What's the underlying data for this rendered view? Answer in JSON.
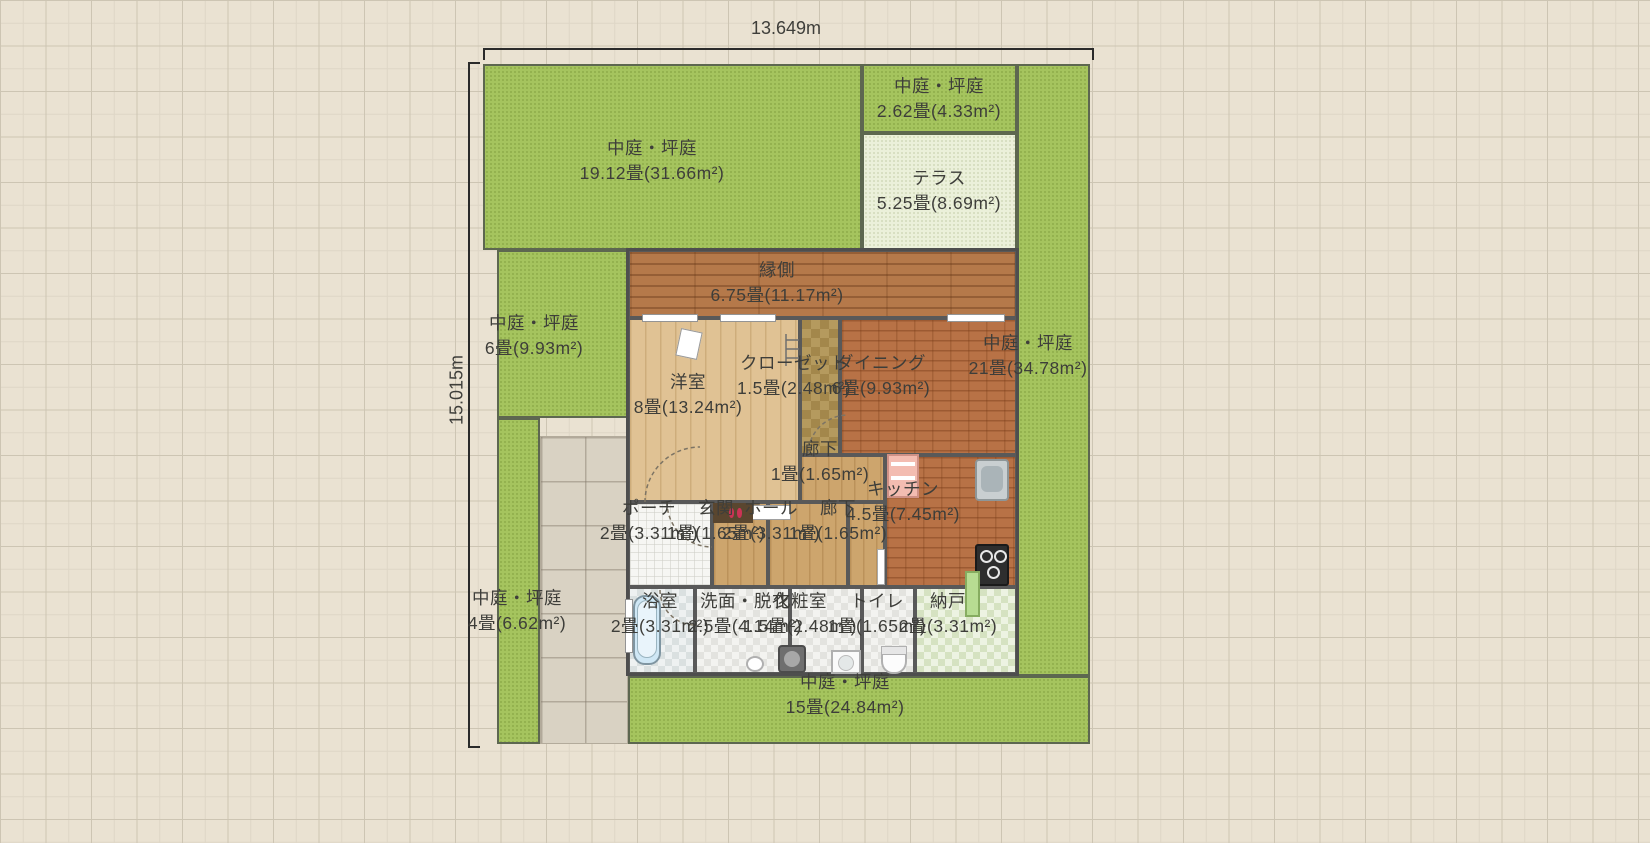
{
  "dimensions": {
    "width_label": "13.649m",
    "height_label": "15.015m"
  },
  "gardens": {
    "g19": {
      "name": "中庭・坪庭",
      "area": "19.12畳(31.66m²)"
    },
    "g262": {
      "name": "中庭・坪庭",
      "area": "2.62畳(4.33m²)"
    },
    "terrace": {
      "name": "テラス",
      "area": "5.25畳(8.69m²)"
    },
    "g21": {
      "name": "中庭・坪庭",
      "area": "21畳(34.78m²)"
    },
    "g6": {
      "name": "中庭・坪庭",
      "area": "6畳(9.93m²)"
    },
    "g4": {
      "name": "中庭・坪庭",
      "area": "4畳(6.62m²)"
    },
    "g15": {
      "name": "中庭・坪庭",
      "area": "15畳(24.84m²)"
    }
  },
  "rooms": {
    "engawa": {
      "name": "縁側",
      "area": "6.75畳(11.17m²)"
    },
    "youshitsu": {
      "name": "洋室",
      "area": "8畳(13.24m²)"
    },
    "closet": {
      "name": "クローゼット",
      "area": "1.5畳(2.48m²)"
    },
    "dining": {
      "name": "ダイニング",
      "area": "6畳(9.93m²)"
    },
    "rouka1": {
      "name": "廊下",
      "area": "1畳(1.65m²)"
    },
    "kitchen": {
      "name": "キッチン",
      "area": "4.5畳(7.45m²)"
    },
    "porch": {
      "name": "ポーチ",
      "area": "2畳(3.31m²)"
    },
    "genkan": {
      "name": "玄関",
      "area": "1畳(1.65m²)"
    },
    "hall": {
      "name": "ホール",
      "area": "2畳(3.31m²)"
    },
    "rouka2": {
      "name": "廊下",
      "area": "1畳(1.65m²)"
    },
    "bath": {
      "name": "浴室",
      "area": "2畳(3.31m²)"
    },
    "senmen": {
      "name": "洗面・脱衣",
      "area": "2.5畳(4.14m²)"
    },
    "keshou": {
      "name": "化粧室",
      "area": "1.5畳(2.48m²)"
    },
    "toilet": {
      "name": "トイレ",
      "area": "1畳(1.65m²)"
    },
    "nando": {
      "name": "納戸",
      "area": "2畳(3.31m²)"
    }
  },
  "colors": {
    "garden_green": "#a5c45e",
    "terrace_green": "#ebf0da",
    "engawa_wood": "#b5794a",
    "brick_floor": "#b87246",
    "wall": "#4e4e4e",
    "background": "#eae2d2"
  }
}
